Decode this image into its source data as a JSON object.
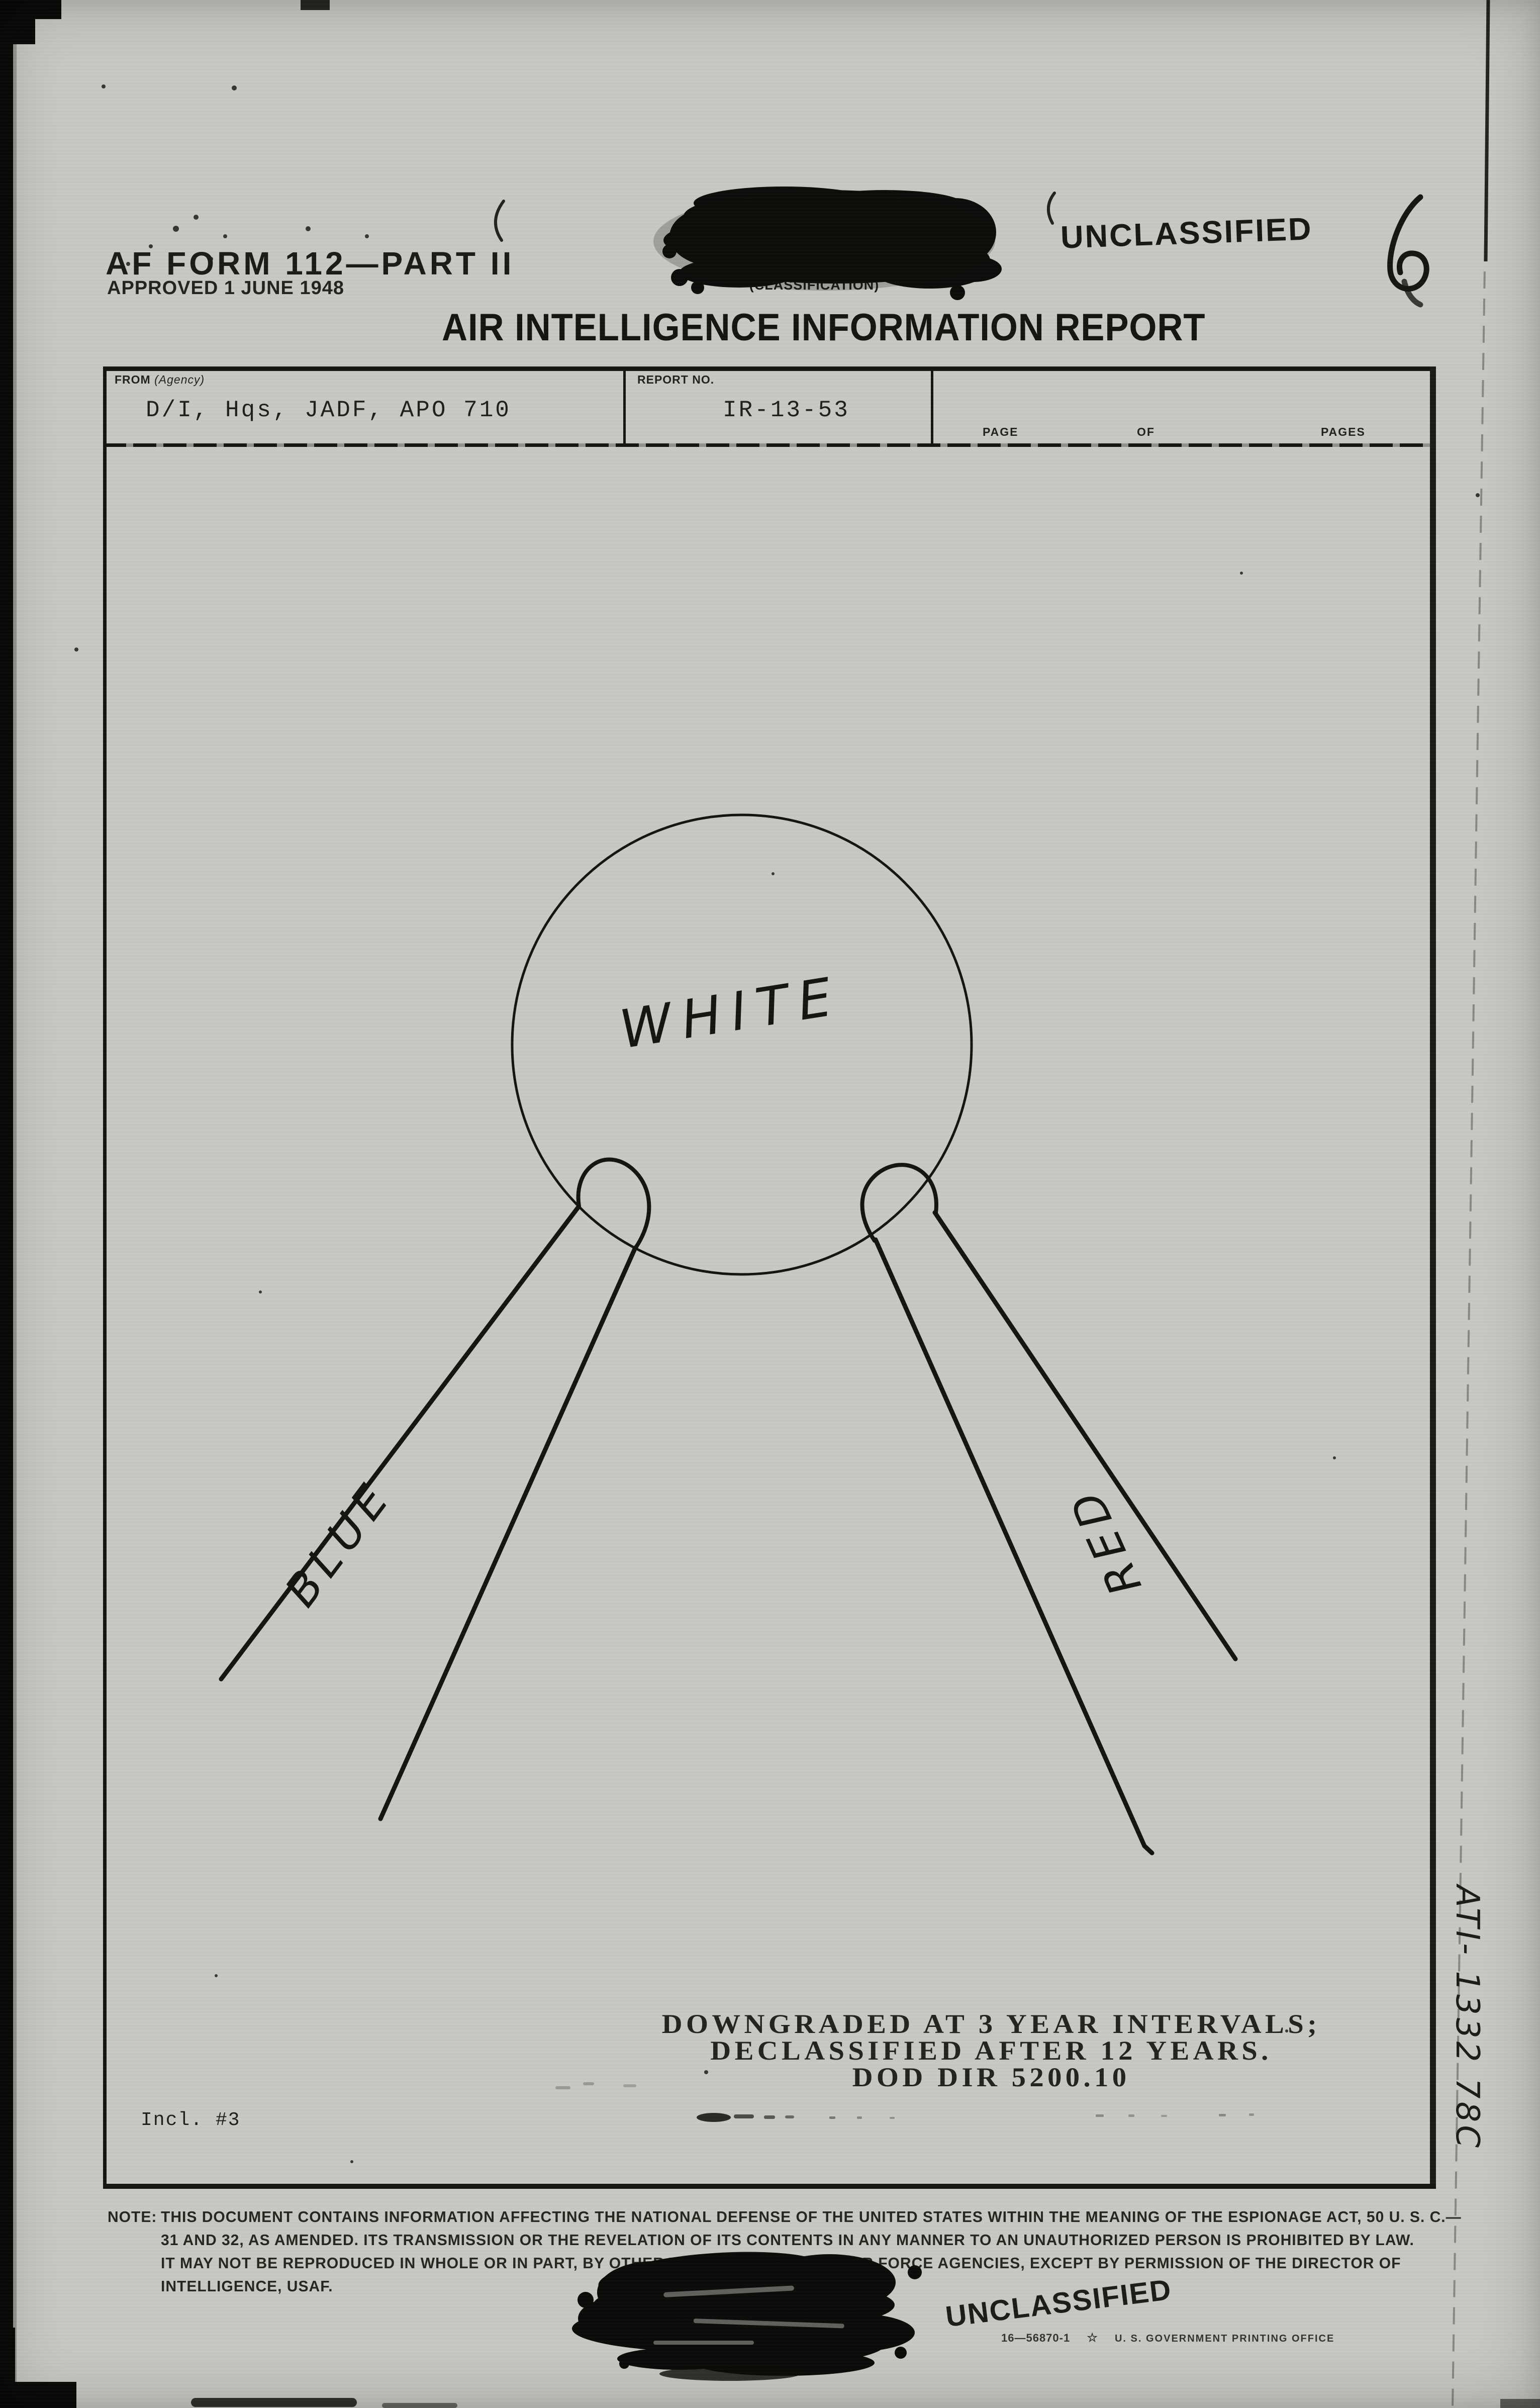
{
  "page_header": {
    "form_id": "AF FORM 112—PART II",
    "form_approved": "APPROVED 1 JUNE 1948",
    "classification_caption": "(CLASSIFICATION)",
    "unclassified_stamp": "UNCLASSIFIED",
    "handwritten_number": "6",
    "title": "AIR INTELLIGENCE INFORMATION REPORT"
  },
  "report_table": {
    "from_label": "FROM",
    "from_label_sub": "(Agency)",
    "from_value": "D/I, Hqs, JADF, APO 710",
    "report_no_label": "REPORT NO.",
    "report_no_value": "IR-13-53",
    "page_label": "PAGE",
    "of_label": "OF",
    "pages_label": "PAGES"
  },
  "diagram": {
    "circle_label": "WHITE",
    "left_beam_label": "BLUE",
    "right_beam_label": "RED"
  },
  "declass_stamp": {
    "line1": "DOWNGRADED AT 3 YEAR INTERVALS;",
    "line2": "DECLASSIFIED AFTER 12 YEARS.",
    "line3": "DOD DIR 5200.10"
  },
  "annotations": {
    "inclosure": "Incl. #3",
    "margin_note": "ATI- 1332 78C"
  },
  "security_note": {
    "label": "NOTE:",
    "line1": "THIS DOCUMENT CONTAINS INFORMATION AFFECTING THE NATIONAL DEFENSE OF THE UNITED STATES WITHIN THE MEANING OF THE ESPIONAGE ACT, 50 U. S. C.—",
    "line2": "31 AND 32, AS AMENDED.  ITS TRANSMISSION OR THE REVELATION OF ITS CONTENTS IN ANY MANNER TO AN UNAUTHORIZED PERSON IS PROHIBITED BY LAW.",
    "line3": "IT MAY NOT BE REPRODUCED IN WHOLE OR IN PART, BY OTHER THAN UNITED STATES AIR FORCE AGENCIES, EXCEPT BY PERMISSION OF THE DIRECTOR OF",
    "line4": "INTELLIGENCE, USAF."
  },
  "footer": {
    "unclassified_stamp": "UNCLASSIFIED",
    "print_code": "16—56870-1",
    "print_office": "U. S. GOVERNMENT PRINTING OFFICE"
  },
  "colors": {
    "paper": "#c7c8c3",
    "ink": "#17170f",
    "stamp_ink": "#23231e"
  }
}
